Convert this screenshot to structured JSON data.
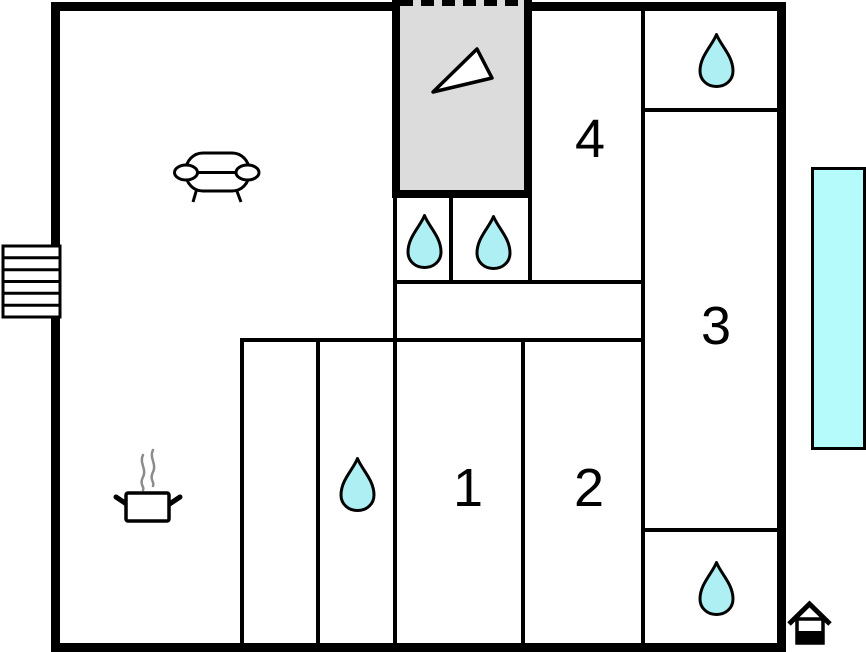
{
  "floor_plan": {
    "room_labels": [
      {
        "label": "1"
      },
      {
        "label": "2"
      },
      {
        "label": "3"
      },
      {
        "label": "4"
      }
    ],
    "water_drop_count": 5,
    "unlabeled_rooms": [
      "living-kitchen-area",
      "entrance-area",
      "toilet-1",
      "toilet-2",
      "bathroom-top-right",
      "bathroom-bottom-right",
      "hallway",
      "storage-room"
    ]
  },
  "colors": {
    "wall": "#000000",
    "background": "#ffffff",
    "water_drop": "#aeeff3",
    "terrace": "#b5fbfc",
    "entrance_gray": "#dcdcdc",
    "steam": "#8c8c8c"
  },
  "icons": {
    "water_drop": "water-drop-icon",
    "sofa": "sofa-icon",
    "cooking_pot": "cooking-pot-icon",
    "stairs": "stairs-icon",
    "entrance_arrow": "entrance-arrow-icon",
    "house_marker": "house-icon"
  }
}
